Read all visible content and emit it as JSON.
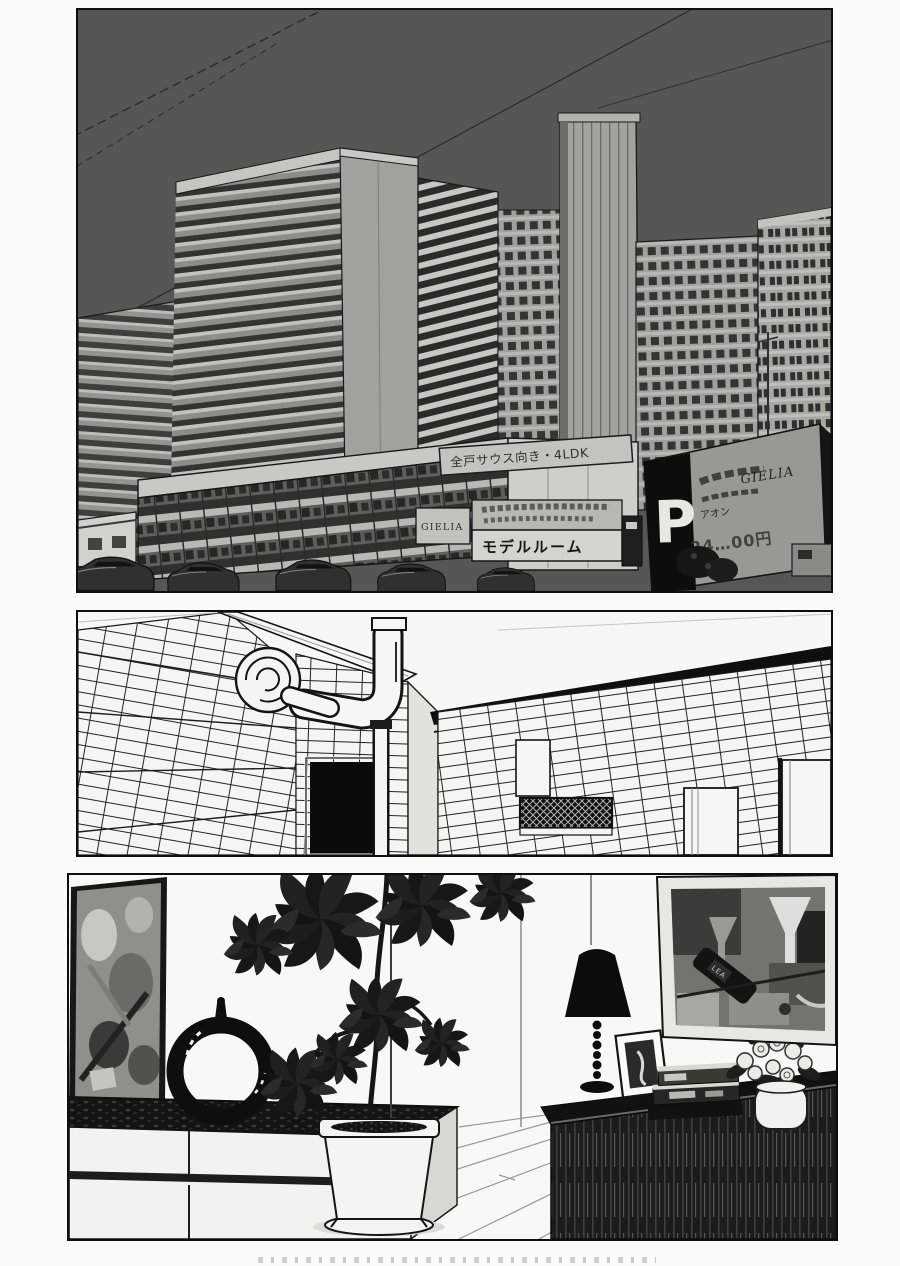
{
  "page": {
    "kind": "manga page, three borderless-gutter panels, black and white",
    "background": "#fbfbf9",
    "ink": "#0e0e0c",
    "cropped_caption_visible": true
  },
  "colors": {
    "sky": "#565654",
    "building_gray": "#a4a49f",
    "building_shadow": "#3e3e3a",
    "paper_white": "#f6f6f3",
    "billboard_dark": "#0d0d0b"
  },
  "panels": {
    "p1": {
      "scene": "high-rise apartment complex exterior, dark sky, power lines, shops and parked cars below",
      "signs": {
        "banner": "全戸サウス向き・4LDK",
        "gielia_board": "GIELIA",
        "model_room": "モデルルーム",
        "parking_letter": "P",
        "parking_store": "アオン",
        "parking_price": "24…00円",
        "gielia_logo": "GIELIA"
      }
    },
    "p2": {
      "scene": "tiled apartment service corridor with exhaust fan, elbow pipes, dark doorway and doors"
    },
    "p3": {
      "scene": "living-room corner: abstract paintings, ring sculpture on white cabinet, tall potted plant, dark sideboard with lamp, photo frame, books and flower vase",
      "painting_bottle_label": "LEA"
    }
  }
}
